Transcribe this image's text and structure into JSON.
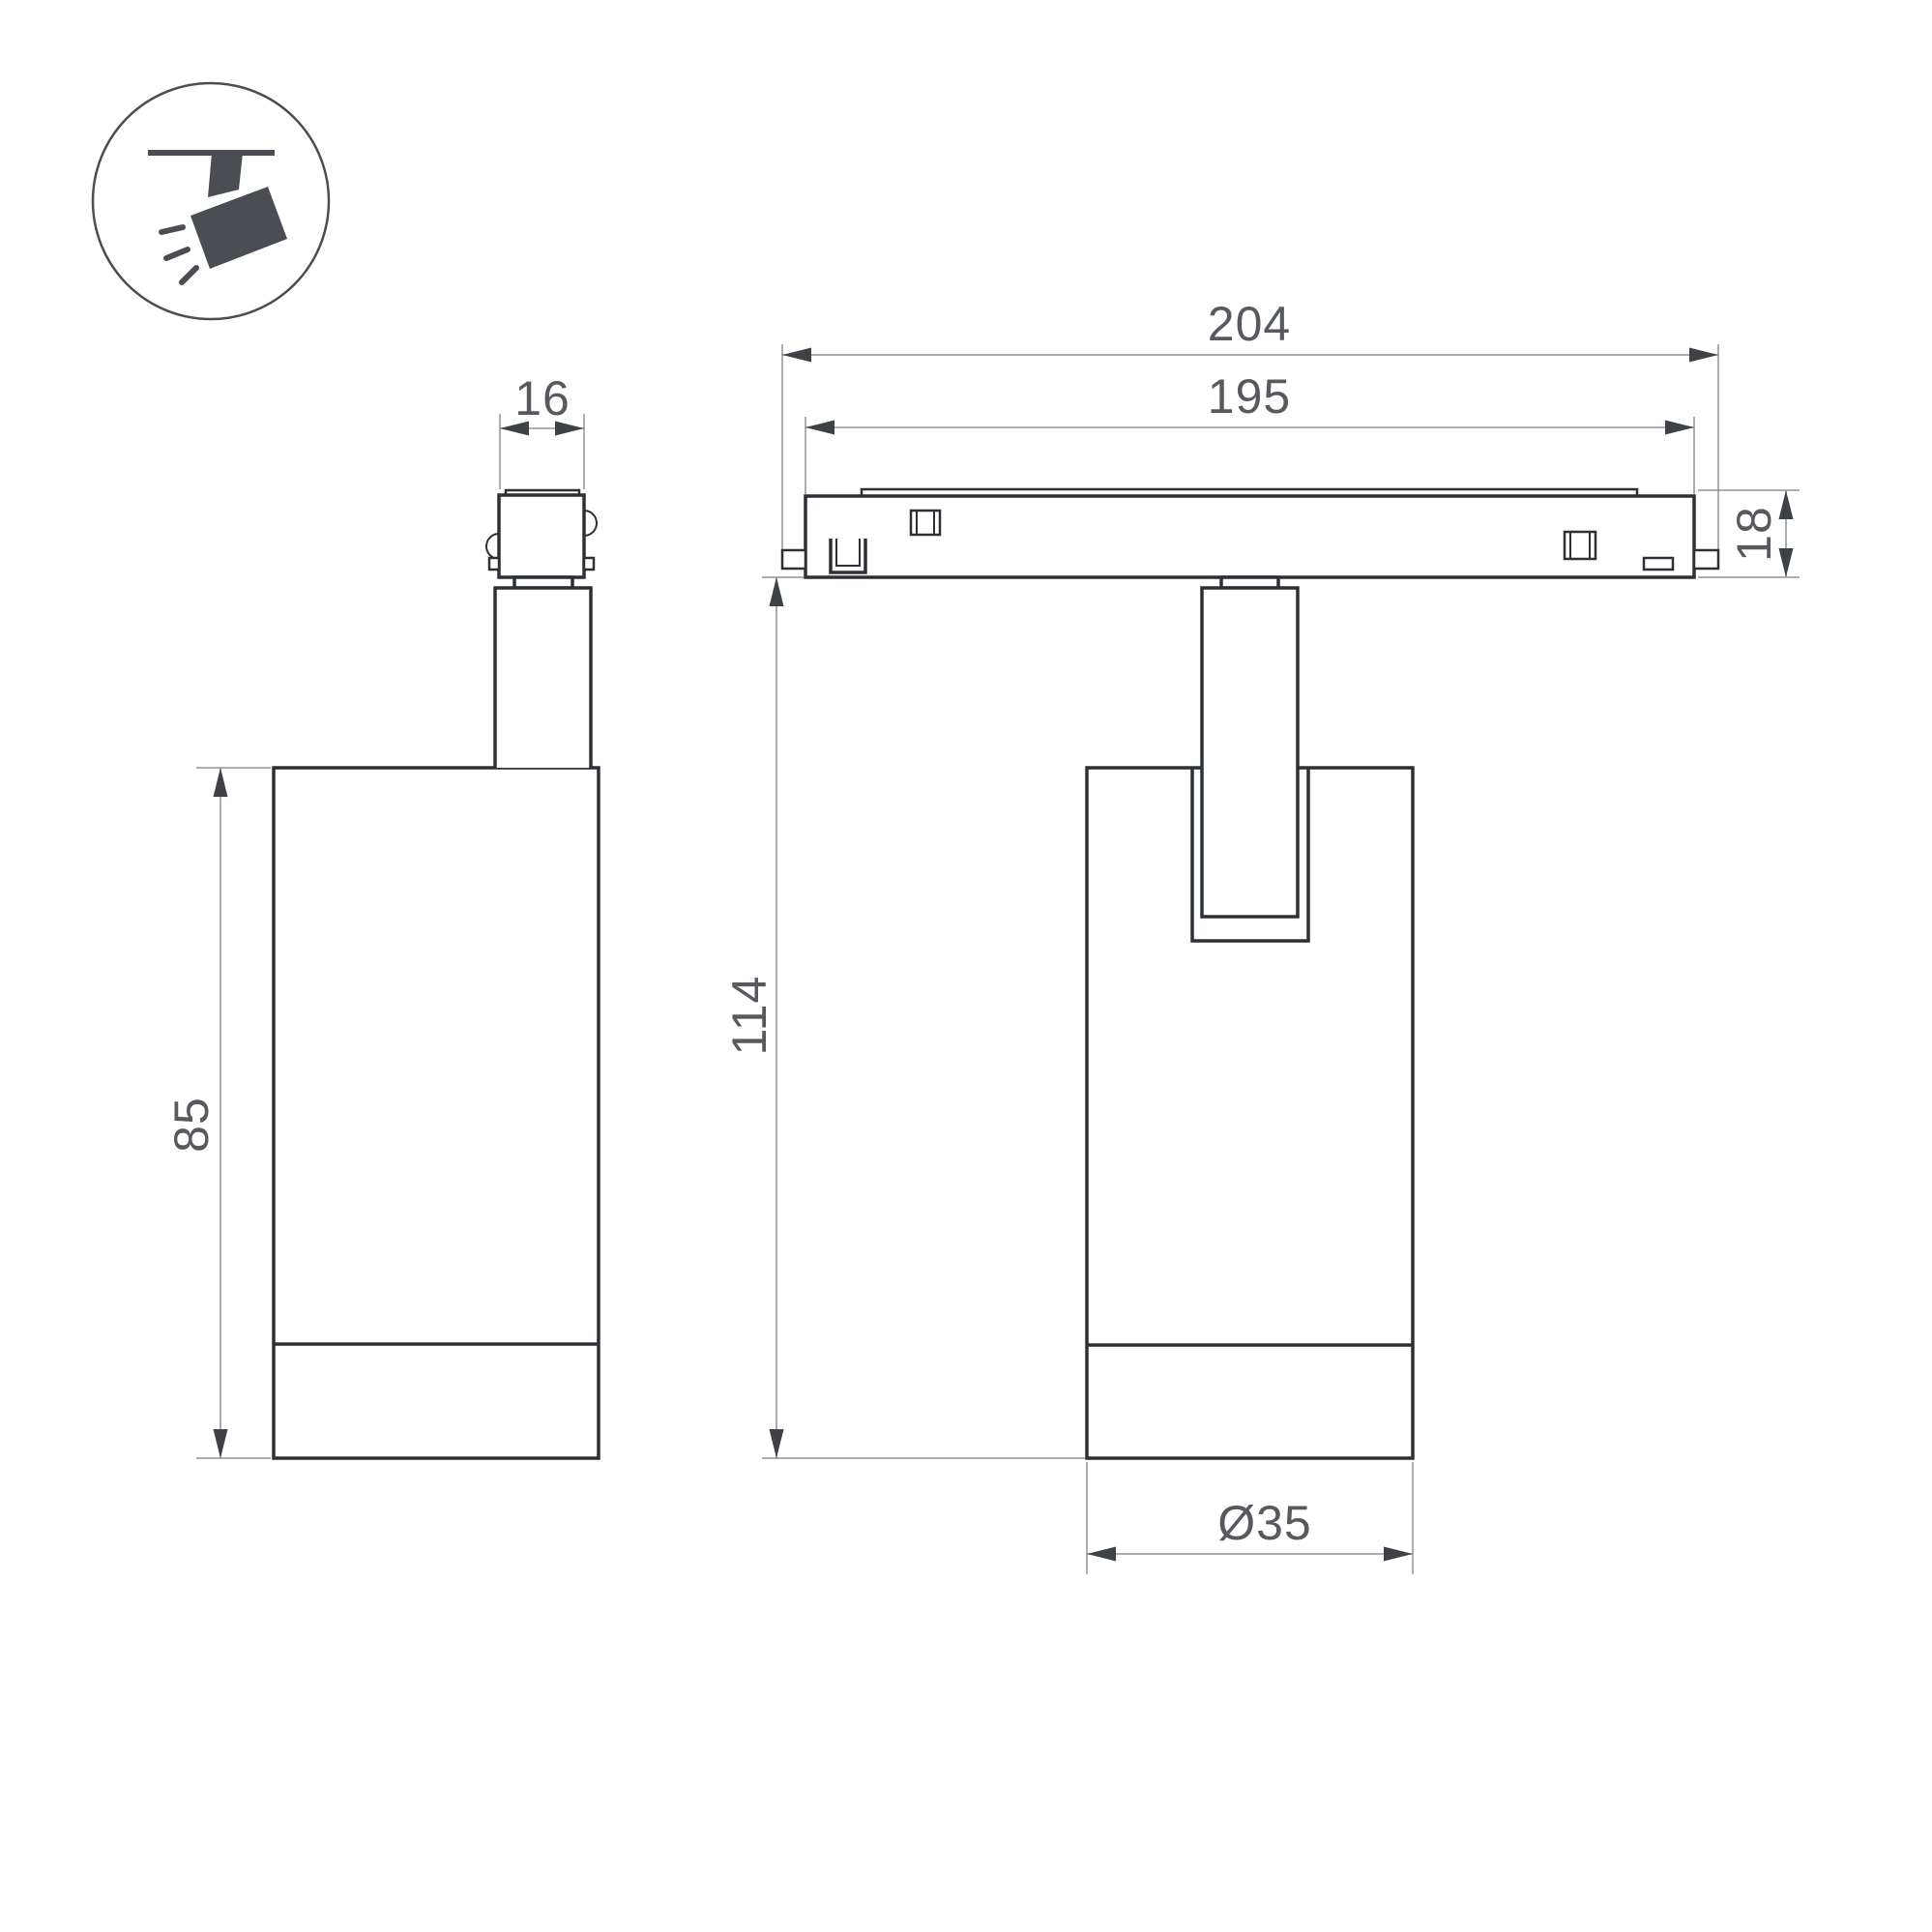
{
  "drawing": {
    "title": "track-spotlight-dimensional-drawing",
    "icon": {
      "name": "ceiling-track-spotlight-icon"
    },
    "views": {
      "side": {
        "name": "side-view"
      },
      "front": {
        "name": "front-view"
      }
    },
    "dimensions": {
      "adapter_width": {
        "label": "16"
      },
      "overall_length": {
        "label": "204"
      },
      "track_length": {
        "label": "195"
      },
      "track_height": {
        "label": "18"
      },
      "body_height": {
        "label": "85"
      },
      "overall_height": {
        "label": "114"
      },
      "body_diameter": {
        "label": "Ø35"
      }
    },
    "colors": {
      "background": "#ffffff",
      "outline": "#2d3135",
      "dimension_line": "#8f9295",
      "arrowhead": "#3e4247",
      "dimension_text": "#56595d",
      "icon": "#4a4e54"
    }
  }
}
